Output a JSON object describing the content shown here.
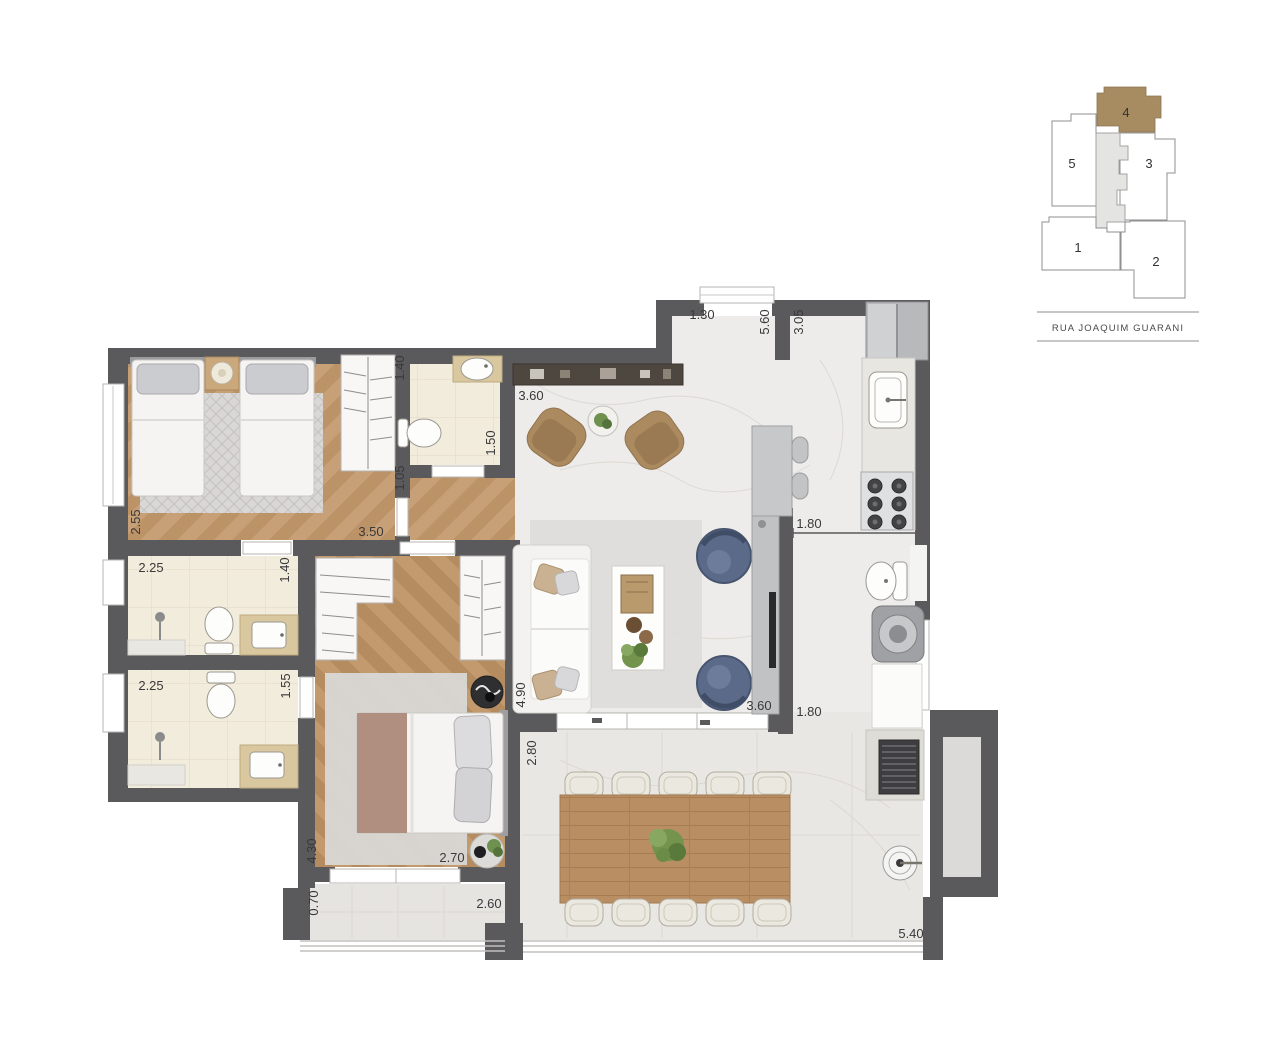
{
  "floorplan": {
    "dimensions": [
      {
        "value": "1.30",
        "orientation": "horizontal",
        "location": "entry-door"
      },
      {
        "value": "5.60",
        "orientation": "vertical",
        "location": "living-length"
      },
      {
        "value": "3.05",
        "orientation": "vertical",
        "location": "kitchen-length"
      },
      {
        "value": "3.60",
        "orientation": "horizontal",
        "location": "living-top-width"
      },
      {
        "value": "1.40",
        "orientation": "vertical",
        "location": "bathroom-1-width"
      },
      {
        "value": "1.50",
        "orientation": "vertical",
        "location": "bathroom-1-length"
      },
      {
        "value": "1.05",
        "orientation": "vertical",
        "location": "hall-width"
      },
      {
        "value": "2.55",
        "orientation": "vertical",
        "location": "bedroom-1-depth"
      },
      {
        "value": "3.50",
        "orientation": "horizontal",
        "location": "bedroom-1-width"
      },
      {
        "value": "2.25",
        "orientation": "horizontal",
        "location": "bathroom-2-width"
      },
      {
        "value": "1.40",
        "orientation": "vertical",
        "location": "bathroom-2-depth"
      },
      {
        "value": "2.25",
        "orientation": "horizontal",
        "location": "bathroom-3-width"
      },
      {
        "value": "1.55",
        "orientation": "vertical",
        "location": "bathroom-3-depth"
      },
      {
        "value": "1.80",
        "orientation": "horizontal",
        "location": "kitchen-passage-top"
      },
      {
        "value": "4.90",
        "orientation": "vertical",
        "location": "living-depth"
      },
      {
        "value": "3.60",
        "orientation": "horizontal",
        "location": "living-bottom-width"
      },
      {
        "value": "1.80",
        "orientation": "horizontal",
        "location": "kitchen-passage-bottom"
      },
      {
        "value": "2.80",
        "orientation": "vertical",
        "location": "terrace-depth"
      },
      {
        "value": "4.30",
        "orientation": "vertical",
        "location": "master-bedroom-depth"
      },
      {
        "value": "2.70",
        "orientation": "horizontal",
        "location": "master-bedroom-width"
      },
      {
        "value": "0.70",
        "orientation": "vertical",
        "location": "balcony-depth"
      },
      {
        "value": "2.60",
        "orientation": "horizontal",
        "location": "balcony-width"
      },
      {
        "value": "5.40",
        "orientation": "horizontal",
        "location": "terrace-width"
      }
    ]
  },
  "keyplan": {
    "units": [
      {
        "label": "1"
      },
      {
        "label": "2"
      },
      {
        "label": "3"
      },
      {
        "label": "4"
      },
      {
        "label": "5"
      }
    ],
    "highlighted_unit": "4",
    "street": "RUA JOAQUIM GUARANI"
  },
  "colors": {
    "wall": "#5a595c",
    "wood_floor": "#c49a6c",
    "marble_floor": "#edecea",
    "bath_floor": "#f2ecdc",
    "highlight_unit": "#a78c62",
    "armchair_blue": "#5b6a89",
    "dining_wood": "#b98e63"
  }
}
